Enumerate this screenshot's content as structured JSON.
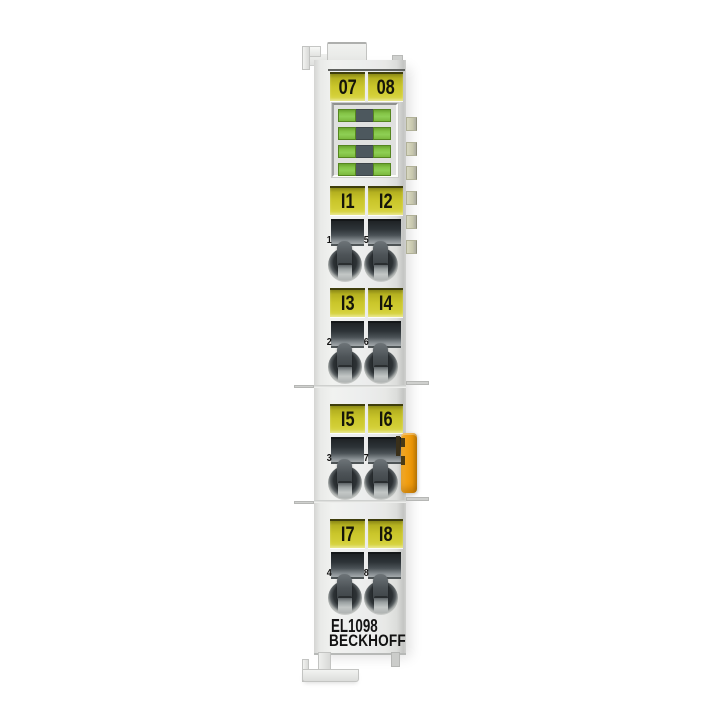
{
  "product": {
    "model": "EL1098",
    "brand": "BECKHOFF",
    "type": "EtherCAT digital input terminal, 8-channel"
  },
  "top_labels": {
    "left": "07",
    "right": "08"
  },
  "led_panel": {
    "rows": 4,
    "leds_per_row": 2,
    "states": [
      {
        "left": "green",
        "right": "green"
      },
      {
        "left": "green",
        "right": "green"
      },
      {
        "left": "green",
        "right": "green"
      },
      {
        "left": "green",
        "right": "green"
      }
    ]
  },
  "sections": [
    {
      "left_label": "I1",
      "right_label": "I2",
      "left_number": "1",
      "right_number": "5"
    },
    {
      "left_label": "I3",
      "right_label": "I4",
      "left_number": "2",
      "right_number": "6"
    },
    {
      "left_label": "I5",
      "right_label": "I6",
      "left_number": "3",
      "right_number": "7"
    },
    {
      "left_label": "I7",
      "right_label": "I8",
      "left_number": "4",
      "right_number": "8"
    }
  ],
  "colors": {
    "label_yellow": "#c8c428",
    "led_green": "#82c245",
    "led_slot_dark": "#4d585e",
    "latch_orange": "#ef9d12",
    "body_gray": "#ebecea",
    "slot_dark": "#2d3337",
    "background": "#ffffff"
  }
}
